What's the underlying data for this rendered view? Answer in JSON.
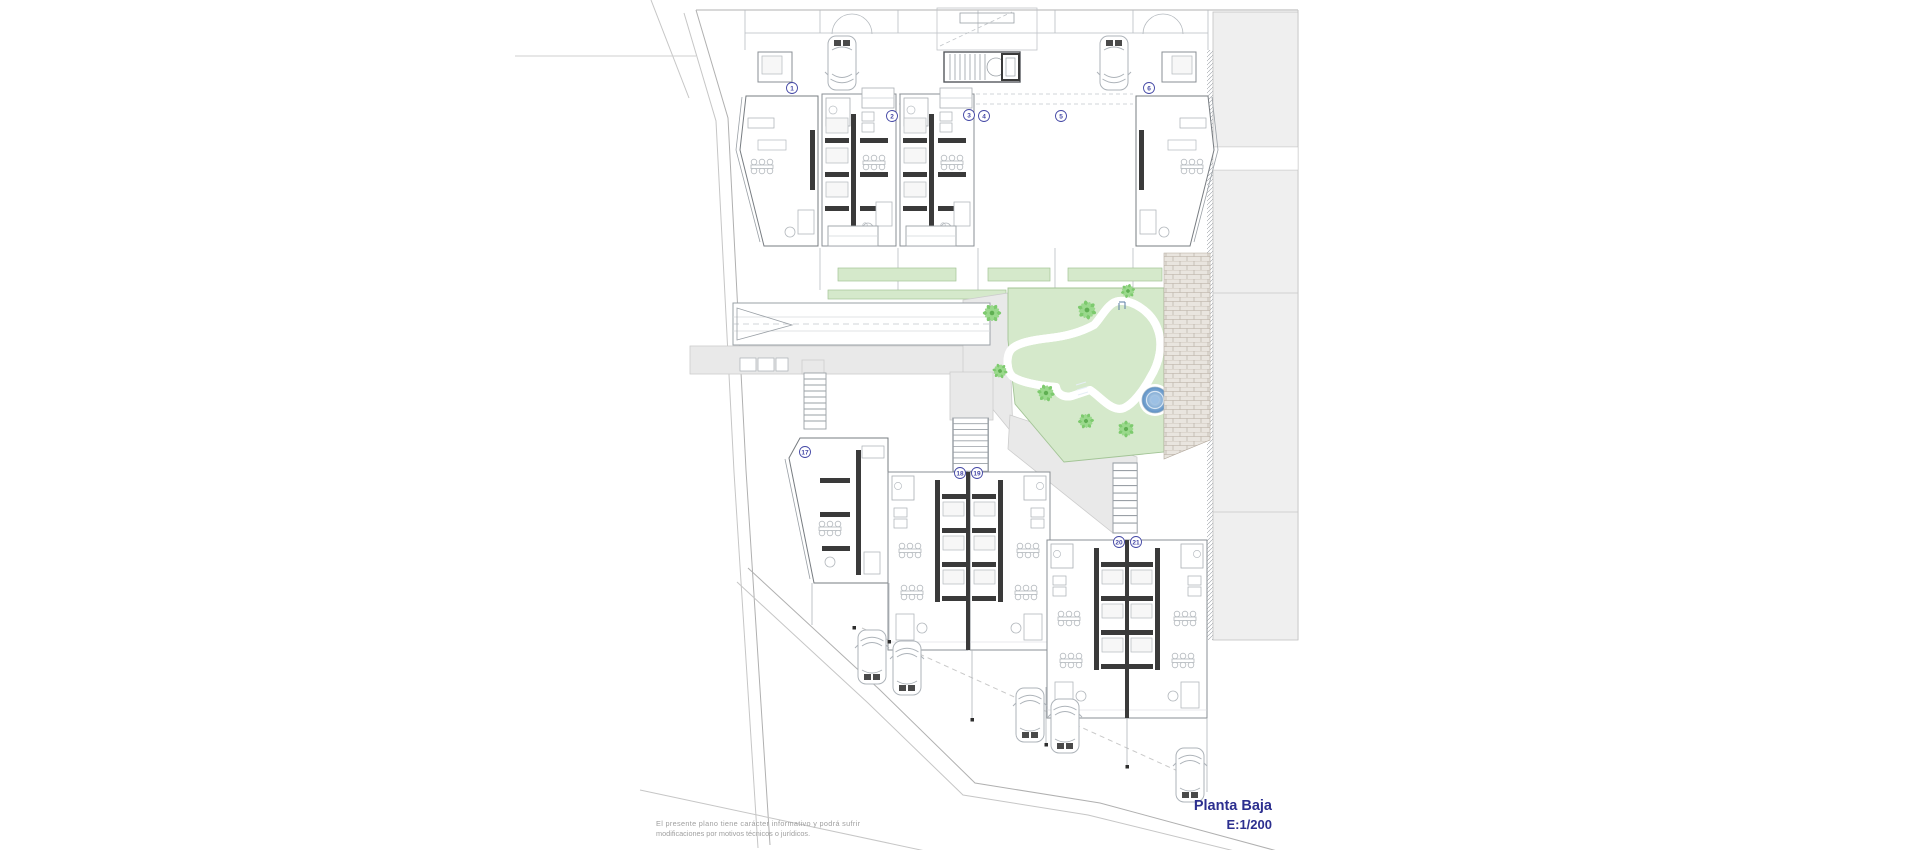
{
  "title_block": {
    "floor_label": "Planta Baja",
    "scale_label": "E:1/200",
    "text_color": "#2c2f8f"
  },
  "disclaimer": {
    "line1": "El presente plano tiene carácter informativo y podrá sufrir",
    "line2": "modificaciones por motivos técnicos o jurídicos.",
    "text_color": "#9f9f9f"
  },
  "units": {
    "top": [
      "1",
      "2",
      "3",
      "4",
      "5",
      "6"
    ],
    "bottom": [
      "17",
      "18",
      "19",
      "20",
      "21"
    ],
    "badge_color": "#4347a5"
  },
  "site": {
    "garden_color": "#d5e9cb",
    "garden_border": "#a3c496",
    "palm_color": "#7dca6e",
    "palm_dark": "#5faf52",
    "pool_light": "#cadff2",
    "pool_dark": "#6d9bce",
    "spa_dark": "#5b8fc4",
    "path_color": "#e9e9e9",
    "path_border": "#cccccc",
    "neighbor_color": "#efefef",
    "deck_color": "#e9e5df",
    "deck_line": "#b3a99d",
    "wall_color": "#3a3a3a",
    "line_color": "#9aa0a6",
    "boundary_color": "#b0b0b0"
  }
}
